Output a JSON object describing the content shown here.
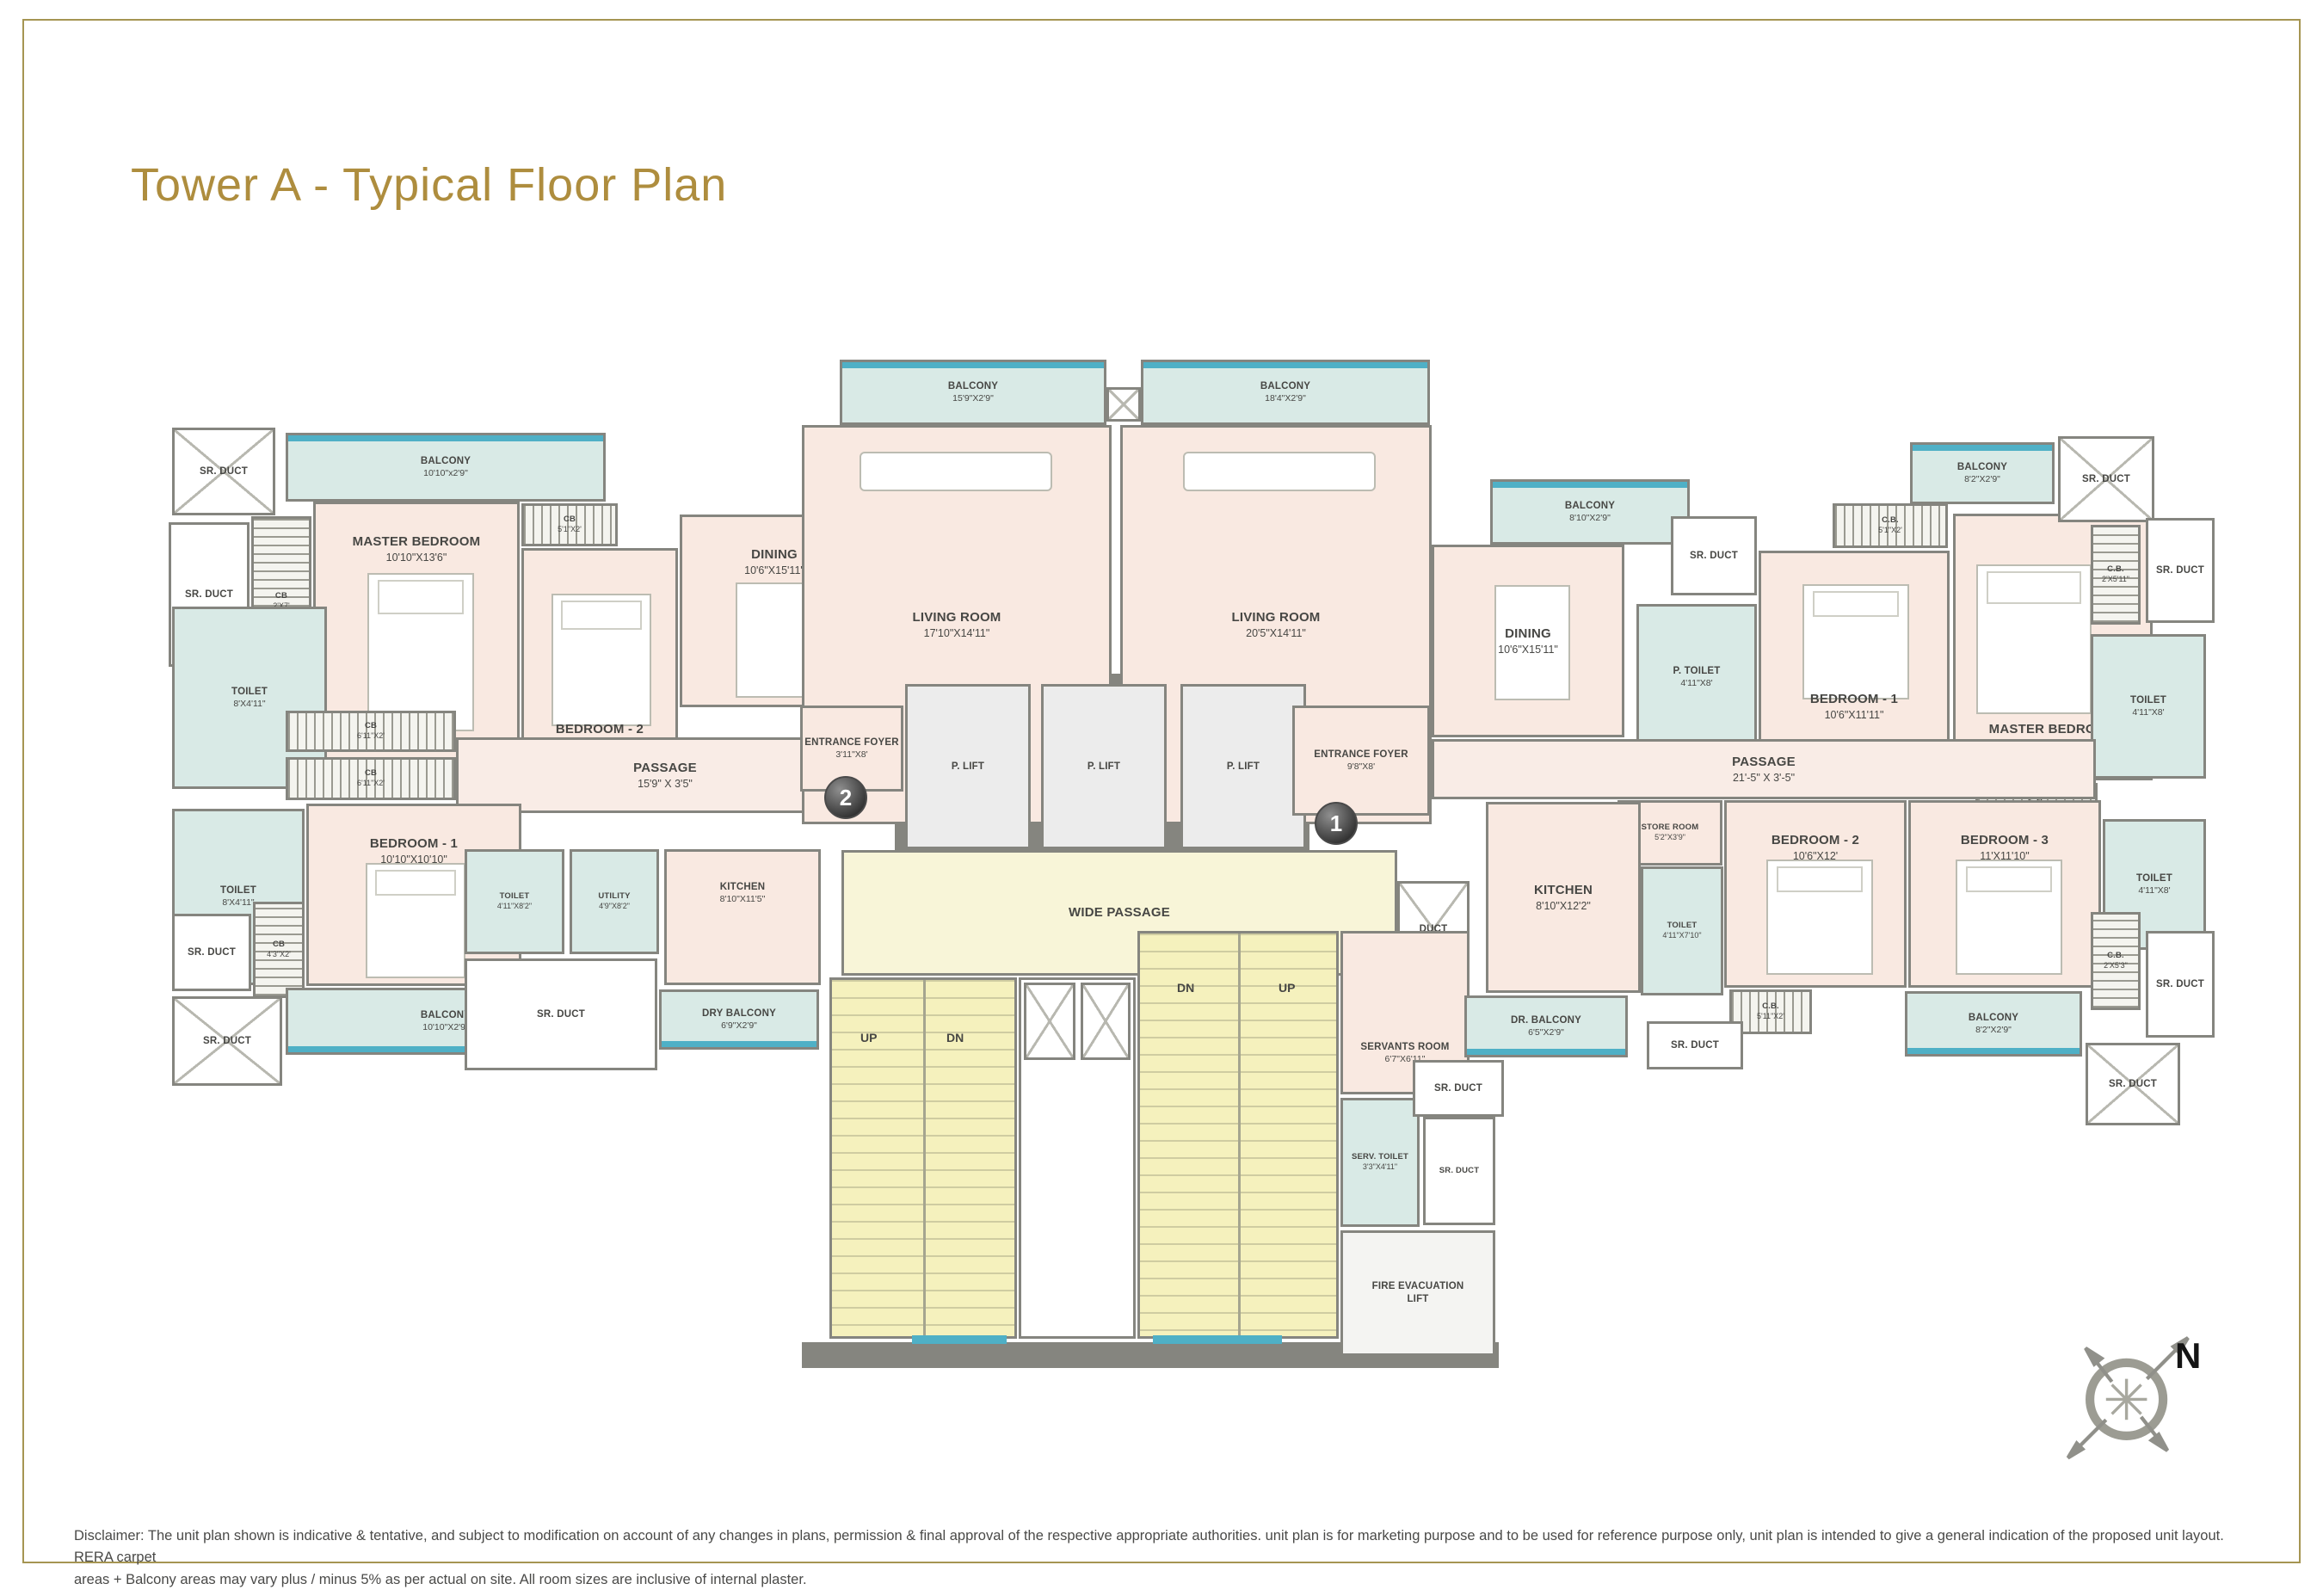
{
  "page": {
    "title": "Tower A - Typical Floor Plan",
    "compass_label": "N",
    "disclaimer_line1": "Disclaimer: The unit plan shown is indicative & tentative, and subject to modification on account of any changes in plans, permission & final approval of the respective appropriate authorities. unit plan is for marketing purpose and to be used for reference purpose only, unit plan is intended to give a general indication of the proposed unit layout. RERA carpet",
    "disclaimer_line2": "areas + Balcony areas may vary plus / minus 5% as per actual on site. All room sizes are inclusive of internal plaster."
  },
  "badges": {
    "unit1": "1",
    "unit2": "2"
  },
  "stairs": {
    "up": "UP",
    "dn": "DN"
  },
  "rooms": {
    "l_srduct_tl": {
      "name": "SR. DUCT",
      "dims": ""
    },
    "l_balcony_top": {
      "name": "BALCONY",
      "dims": "10'10\"x2'9\""
    },
    "l_srduct_left": {
      "name": "SR. DUCT",
      "dims": ""
    },
    "l_cb27": {
      "name": "CB",
      "dims": "2'X7'"
    },
    "l_master": {
      "name": "MASTER BEDROOM",
      "dims": "10'10\"X13'6\""
    },
    "l_cb51": {
      "name": "CB",
      "dims": "5'1\"X2'"
    },
    "l_bed2": {
      "name": "BEDROOM - 2",
      "dims": "10'9\"X11'10\""
    },
    "l_dining": {
      "name": "DINING",
      "dims": "10'6\"X15'11\""
    },
    "l_toilet_top": {
      "name": "TOILET",
      "dims": "8'X4'11\""
    },
    "l_cb611a": {
      "name": "CB",
      "dims": "6'11\"X2'"
    },
    "l_cb611b": {
      "name": "CB",
      "dims": "6'11\"X2'"
    },
    "l_passage": {
      "name": "PASSAGE",
      "dims": "15'9\" X 3'5\""
    },
    "l_toilet_low": {
      "name": "TOILET",
      "dims": "8'X4'11\""
    },
    "l_bed1": {
      "name": "BEDROOM - 1",
      "dims": "10'10\"X10'10\""
    },
    "l_srduct_mid": {
      "name": "SR. DUCT",
      "dims": ""
    },
    "l_cb43": {
      "name": "CB",
      "dims": "4'3\"X2'"
    },
    "l_srduct_bl": {
      "name": "SR. DUCT",
      "dims": ""
    },
    "l_balcony_bot": {
      "name": "BALCONY",
      "dims": "10'10\"X2'9\""
    },
    "l_toilet2": {
      "name": "TOILET",
      "dims": "4'11\"X8'2\""
    },
    "l_utility": {
      "name": "UTILITY",
      "dims": "4'9\"X8'2\""
    },
    "l_kitchen": {
      "name": "KITCHEN",
      "dims": "8'10\"X11'5\""
    },
    "l_srduct_big": {
      "name": "SR. DUCT",
      "dims": ""
    },
    "l_drybalc": {
      "name": "DRY BALCONY",
      "dims": "6'9\"X2'9\""
    },
    "l_foyer": {
      "name": "ENTRANCE FOYER",
      "dims": "3'11\"X8'"
    },
    "c_balc1": {
      "name": "BALCONY",
      "dims": "15'9\"X2'9\""
    },
    "c_balc2": {
      "name": "BALCONY",
      "dims": "18'4\"X2'9\""
    },
    "c_living1": {
      "name": "LIVING ROOM",
      "dims": "17'10\"X14'11\""
    },
    "c_living2": {
      "name": "LIVING ROOM",
      "dims": "20'5\"X14'11\""
    },
    "c_lift1": {
      "name": "P. LIFT",
      "dims": ""
    },
    "c_lift2": {
      "name": "P. LIFT",
      "dims": ""
    },
    "c_lift3": {
      "name": "P. LIFT",
      "dims": ""
    },
    "r_foyer": {
      "name": "ENTRANCE FOYER",
      "dims": "9'8\"X8'"
    },
    "c_wide": {
      "name": "WIDE PASSAGE",
      "dims": ""
    },
    "c_duct": {
      "name": "DUCT",
      "dims": ""
    },
    "c_servants": {
      "name": "SERVANTS ROOM",
      "dims": "6'7\"X6'11\""
    },
    "c_servtoilet": {
      "name": "SERV. TOILET",
      "dims": "3'3\"X4'11\""
    },
    "c_srduct2": {
      "name": "SR. DUCT",
      "dims": ""
    },
    "c_firelift": {
      "name": "FIRE EVACUATION LIFT",
      "dims": ""
    },
    "r_balcony_top": {
      "name": "BALCONY",
      "dims": "8'10\"X2'9\""
    },
    "r_srduct_a": {
      "name": "SR. DUCT",
      "dims": ""
    },
    "r_dining": {
      "name": "DINING",
      "dims": "10'6\"X15'11\""
    },
    "r_ptoilet": {
      "name": "P. TOILET",
      "dims": "4'11\"X8'"
    },
    "r_bed1": {
      "name": "BEDROOM - 1",
      "dims": "10'6\"X11'11\""
    },
    "r_cb51": {
      "name": "C.B.",
      "dims": "5'1\"X2'"
    },
    "r_master": {
      "name": "MASTER BEDROOM",
      "dims": "11'X13'8\""
    },
    "r_balc_tr": {
      "name": "BALCONY",
      "dims": "8'2\"X2'9\""
    },
    "r_srduct_tr": {
      "name": "SR. DUCT",
      "dims": ""
    },
    "r_cb2511": {
      "name": "C.B.",
      "dims": "2'X5'11\""
    },
    "r_srduct_r1": {
      "name": "SR. DUCT",
      "dims": ""
    },
    "r_toilet_tr": {
      "name": "TOILET",
      "dims": "4'11\"X8'"
    },
    "r_cb71a": {
      "name": "C.B.",
      "dims": "7'1\"X2'"
    },
    "r_cb71b": {
      "name": "C.B.",
      "dims": "7'1\"X2'"
    },
    "r_passage": {
      "name": "PASSAGE",
      "dims": "21'-5\" X 3'-5\""
    },
    "r_store": {
      "name": "STORE ROOM",
      "dims": "5'2\"X3'9\""
    },
    "r_kitchen": {
      "name": "KITCHEN",
      "dims": "8'10\"X12'2\""
    },
    "r_toilet_k": {
      "name": "TOILET",
      "dims": "4'11\"X7'10\""
    },
    "r_bed2": {
      "name": "BEDROOM - 2",
      "dims": "10'6\"X12'"
    },
    "r_bed3": {
      "name": "BEDROOM - 3",
      "dims": "11'X11'10\""
    },
    "r_toilet_br": {
      "name": "TOILET",
      "dims": "4'11\"X8'"
    },
    "r_cb253": {
      "name": "C.B.",
      "dims": "2'X5'3\""
    },
    "r_srduct_r2": {
      "name": "SR. DUCT",
      "dims": ""
    },
    "r_drybalc": {
      "name": "DR. BALCONY",
      "dims": "6'5\"X2'9\""
    },
    "r_srduct_b1": {
      "name": "SR. DUCT",
      "dims": ""
    },
    "r_cb5112": {
      "name": "C.B.",
      "dims": "5'11\"X2'"
    },
    "r_srduct_b2": {
      "name": "SR. DUCT",
      "dims": ""
    },
    "r_balc_br": {
      "name": "BALCONY",
      "dims": "8'2\"X2'9\""
    },
    "r_srduct_br": {
      "name": "SR. DUCT",
      "dims": ""
    }
  }
}
